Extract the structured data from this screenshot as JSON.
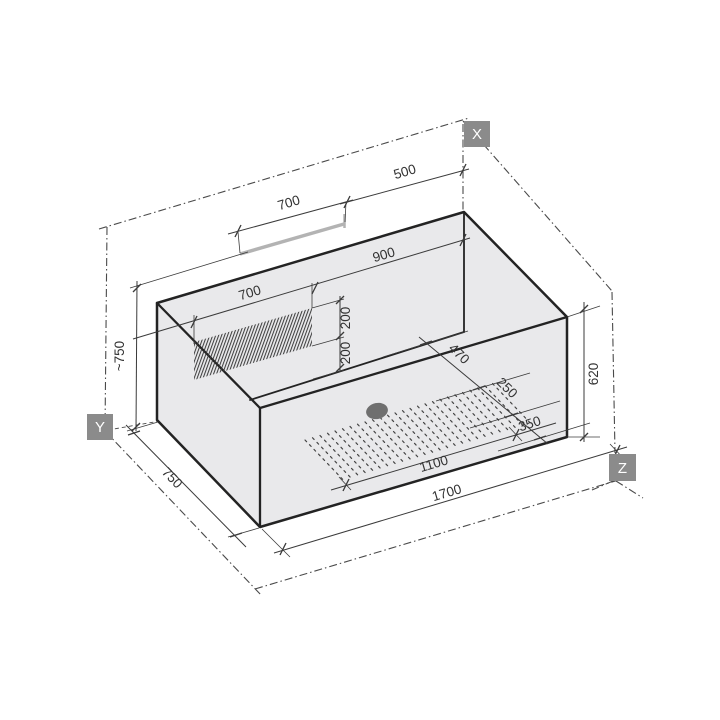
{
  "drawing": {
    "title": "bathtub-isometric-dimension-drawing",
    "axes": {
      "x": "X",
      "y": "Y",
      "z": "Z"
    },
    "dimensions": {
      "rail_length": "700",
      "top_right_offset": "500",
      "back_wall_segment": "900",
      "hatch_length": "700",
      "hatch_upper_height": "200",
      "hatch_lower_height": "200",
      "overall_height": "~750",
      "overall_width": "750",
      "inner_depth": "620",
      "floor_back_offset": "470",
      "antislip_width": "250",
      "floor_right_offset": "350",
      "antislip_length": "1100",
      "overall_length": "1700"
    },
    "colors": {
      "background": "#ffffff",
      "body_fill": "#e9e9eb",
      "outline": "#232323",
      "dim": "#3b3b3b",
      "dim_text": "#333333",
      "dash": "#4a4a4a",
      "axis_box": "#8b8b8b",
      "axis_text": "#ffffff",
      "rail": "#b3b3b3",
      "drain": "#6f6f6f",
      "hatch": "#383838",
      "dots": "#454545"
    }
  }
}
